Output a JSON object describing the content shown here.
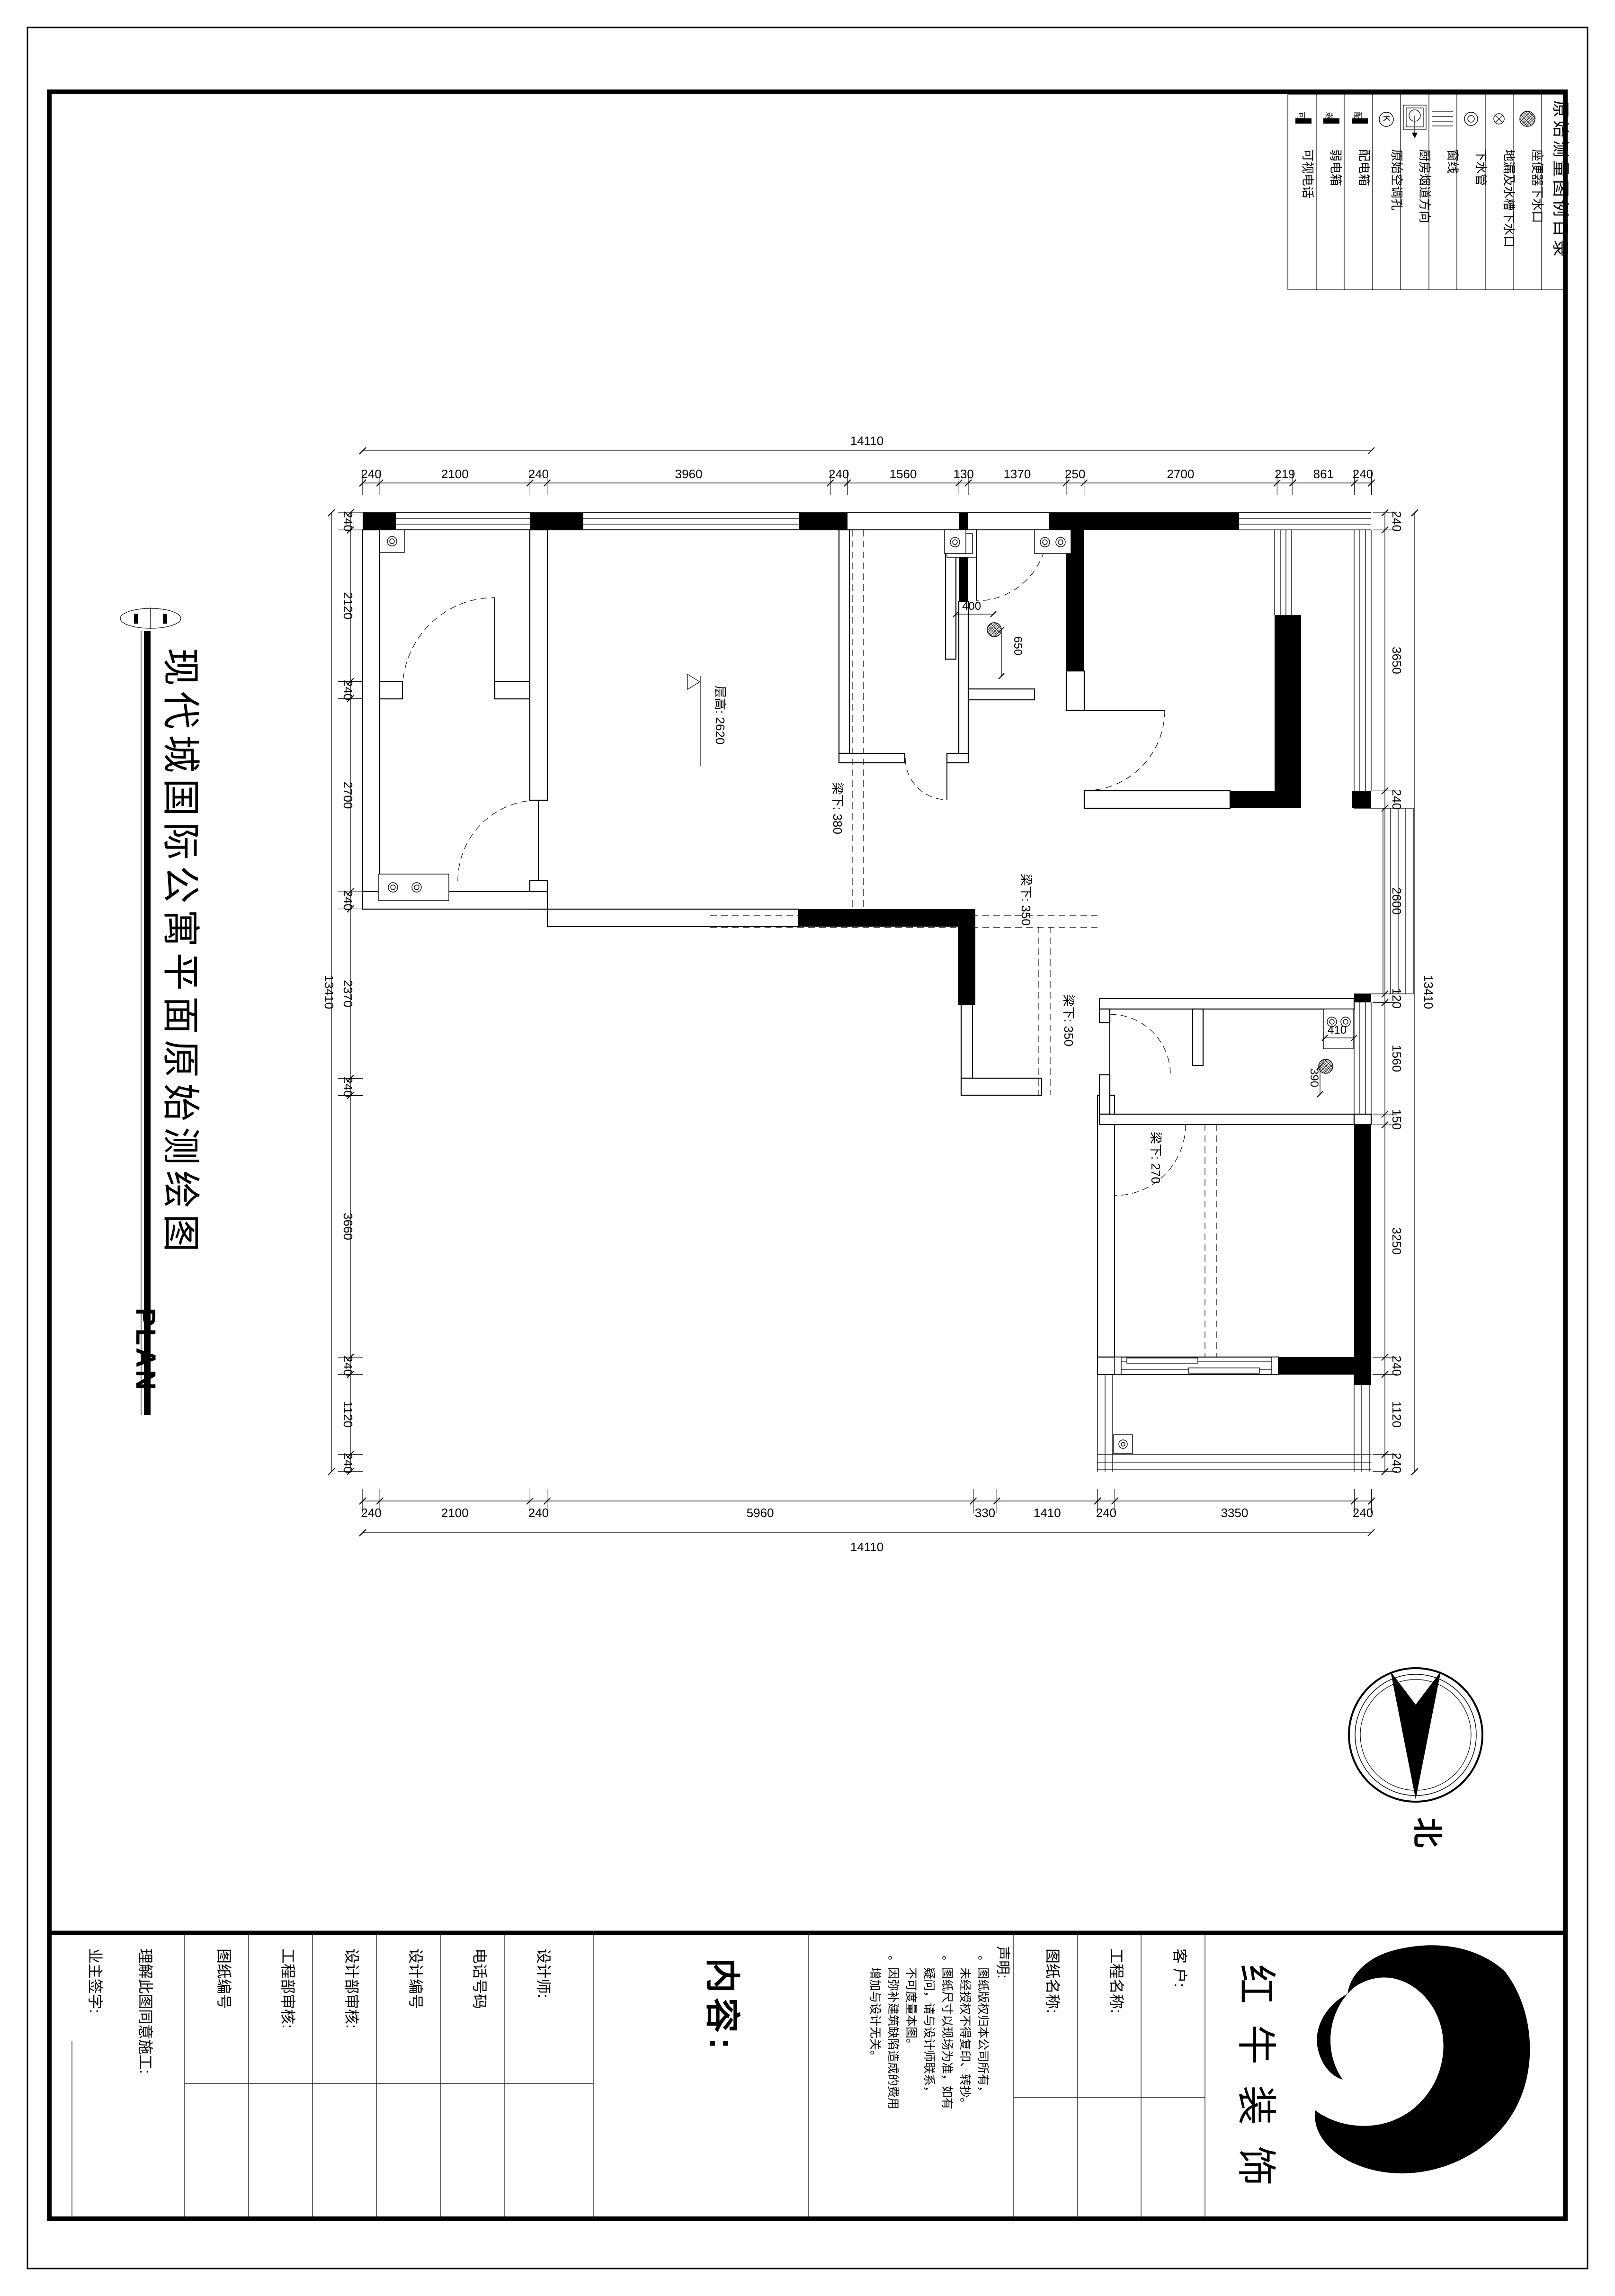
{
  "sheet": {
    "title": "现代城国际公寓平面原始测绘图",
    "subtitle": "PLAN",
    "north_label": "北"
  },
  "legend": {
    "title": "原始测量图例目录",
    "items": [
      {
        "icon": "videophone-icon",
        "label": "可视电话",
        "tag": "可"
      },
      {
        "icon": "weak-current-box-icon",
        "label": "弱电箱",
        "tag": "弱"
      },
      {
        "icon": "power-box-icon",
        "label": "配电箱",
        "tag": "配"
      },
      {
        "icon": "ac-hole-icon",
        "label": "原始空调孔",
        "tag": "K"
      },
      {
        "icon": "kitchen-flue-icon",
        "label": "厨房烟道方向",
        "tag": ""
      },
      {
        "icon": "window-line-icon",
        "label": "窗线",
        "tag": ""
      },
      {
        "icon": "drain-pipe-icon",
        "label": "下水管",
        "tag": ""
      },
      {
        "icon": "floor-drain-icon",
        "label": "地漏及水槽下水口",
        "tag": ""
      },
      {
        "icon": "toilet-drain-icon",
        "label": "座便器下水口",
        "tag": ""
      }
    ]
  },
  "plan": {
    "floor_height_label": "层高: 2620",
    "beam_380": "梁下: 380",
    "beam_350a": "梁下: 350",
    "beam_350b": "梁下: 350",
    "beam_270": "梁下: 270",
    "dim_400": "400",
    "dim_650": "650",
    "dim_410": "410",
    "dim_390": "390",
    "dims": {
      "top_total": "14110",
      "bottom_total": "14110",
      "left_total": "13410",
      "right_total": "13410",
      "top": [
        240,
        2100,
        240,
        3960,
        240,
        1560,
        130,
        1370,
        250,
        2700,
        219,
        861,
        240
      ],
      "bottom": [
        240,
        2100,
        240,
        5960,
        330,
        1410,
        240,
        3350,
        240
      ],
      "left": [
        240,
        2120,
        240,
        2700,
        240,
        2370,
        240,
        3660,
        240,
        1120,
        240
      ],
      "right": [
        240,
        3650,
        240,
        2600,
        120,
        1560,
        150,
        3250,
        240,
        1120,
        240
      ]
    }
  },
  "title_block": {
    "owner_sign": "业主签字:",
    "agree": "理解此图同意施工:",
    "fields": [
      "图纸编号",
      "工程部审核:",
      "设计部审核:",
      "设计编号",
      "电话号码",
      "设计师:"
    ],
    "content_label": "内容:",
    "statement": {
      "heading": "声明:",
      "lines": [
        "。图纸版权归本公司所有，",
        "未经授权不得复印、转抄。",
        "。图纸尺寸以现场为准，如有",
        "疑问，请与设计师联系，",
        "不可度量本图。",
        "。因弥补建筑缺陷造成的费用",
        "增加与设计无关。"
      ]
    },
    "name_fields": [
      "图纸名称:",
      "工程名称:",
      "客  户:"
    ],
    "company_chars": [
      "红",
      "牛",
      "装",
      "饰"
    ]
  }
}
